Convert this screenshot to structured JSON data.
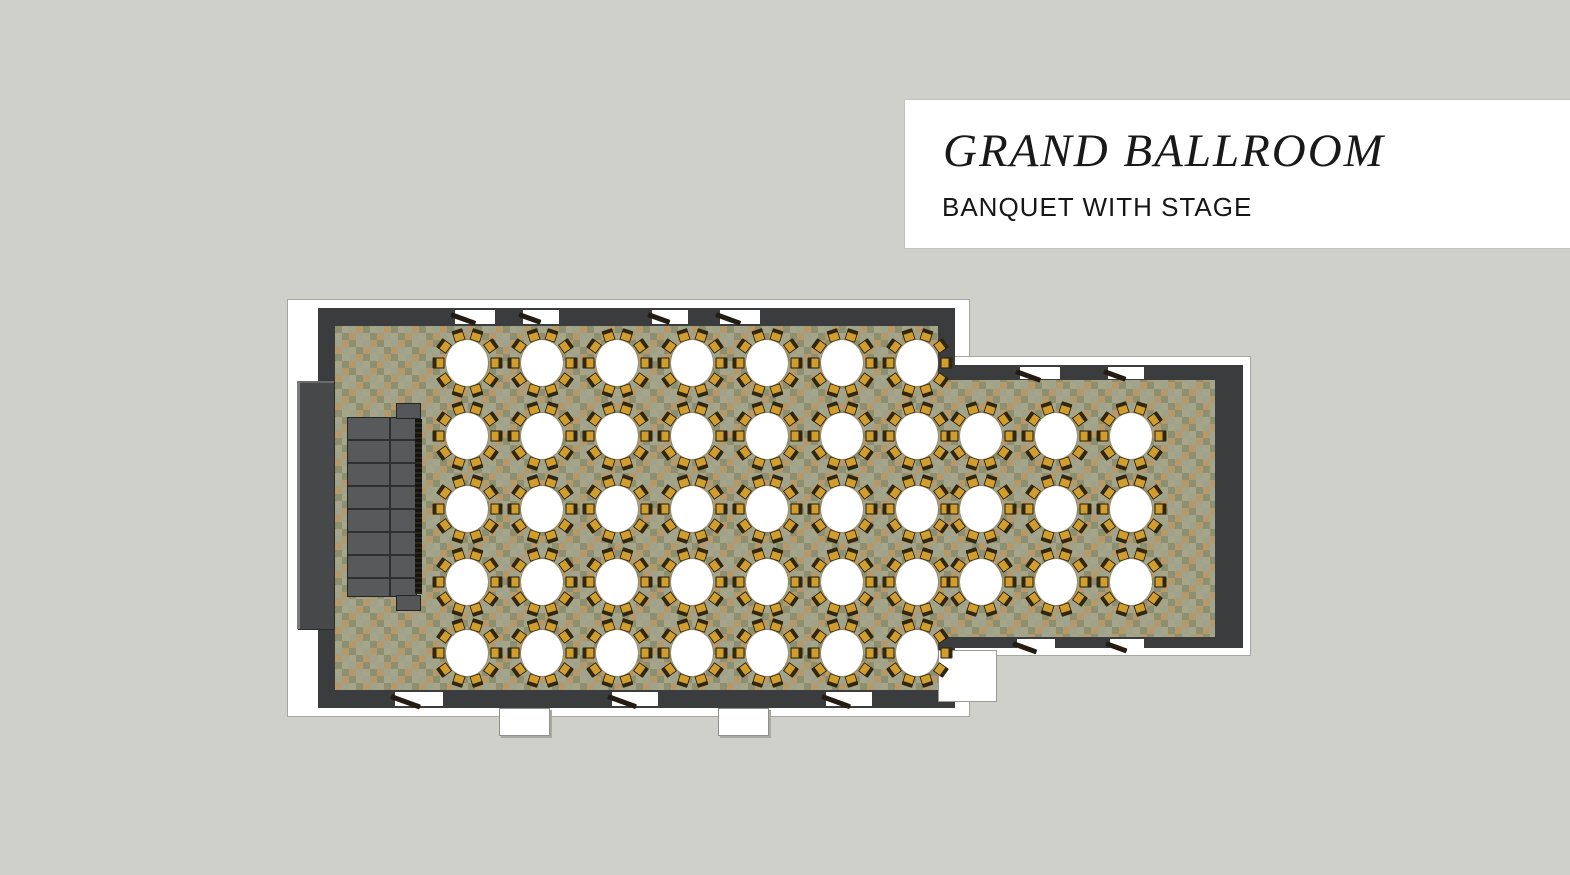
{
  "background_color": "#cfd0ca",
  "title_card": {
    "title": "GRAND BALLROOM",
    "subtitle": "BANQUET WITH STAGE",
    "background": "#ffffff",
    "text_color": "#191919"
  },
  "floorplan": {
    "room_name": "Grand Ballroom",
    "layout_name": "Banquet with Stage",
    "colors": {
      "wall": "#3b3c3e",
      "trim": "#ffffff",
      "carpet_base": "#8d9070",
      "carpet_check_tan": "#b6996a",
      "carpet_check_sage": "#a3a78f",
      "stage": "#58595b",
      "stage_fringe": "#15130f",
      "table_top": "#ffffff",
      "chair_seat": "#d19d2c",
      "chair_back": "#31270f"
    },
    "stage": {
      "label": "stage-platform",
      "sections_note": "segmented platform with side steps"
    },
    "tables": {
      "total": 44,
      "seats_per_table": 10,
      "rows": [
        {
          "y": 363,
          "xs": [
            467,
            542,
            617,
            692,
            767,
            842,
            917
          ]
        },
        {
          "y": 436,
          "xs": [
            467,
            542,
            617,
            692,
            767,
            842,
            917,
            981,
            1056,
            1131
          ]
        },
        {
          "y": 509,
          "xs": [
            467,
            542,
            617,
            692,
            767,
            842,
            917,
            981,
            1056,
            1131
          ]
        },
        {
          "y": 582,
          "xs": [
            467,
            542,
            617,
            692,
            767,
            842,
            917,
            981,
            1056,
            1131
          ]
        },
        {
          "y": 653,
          "xs": [
            467,
            542,
            617,
            692,
            767,
            842,
            917
          ]
        }
      ]
    },
    "doors": {
      "top": [
        {
          "x": 455,
          "w": 40
        },
        {
          "x": 523,
          "w": 36
        },
        {
          "x": 652,
          "w": 36
        },
        {
          "x": 720,
          "w": 40
        }
      ],
      "bottom": [
        {
          "x": 395,
          "w": 48
        },
        {
          "x": 612,
          "w": 46
        },
        {
          "x": 826,
          "w": 46
        }
      ],
      "ext_top": [
        {
          "x": 1020,
          "w": 40
        },
        {
          "x": 1108,
          "w": 36
        }
      ],
      "ext_bottom": [
        {
          "x": 1017,
          "w": 38
        },
        {
          "x": 1110,
          "w": 34
        }
      ]
    }
  }
}
